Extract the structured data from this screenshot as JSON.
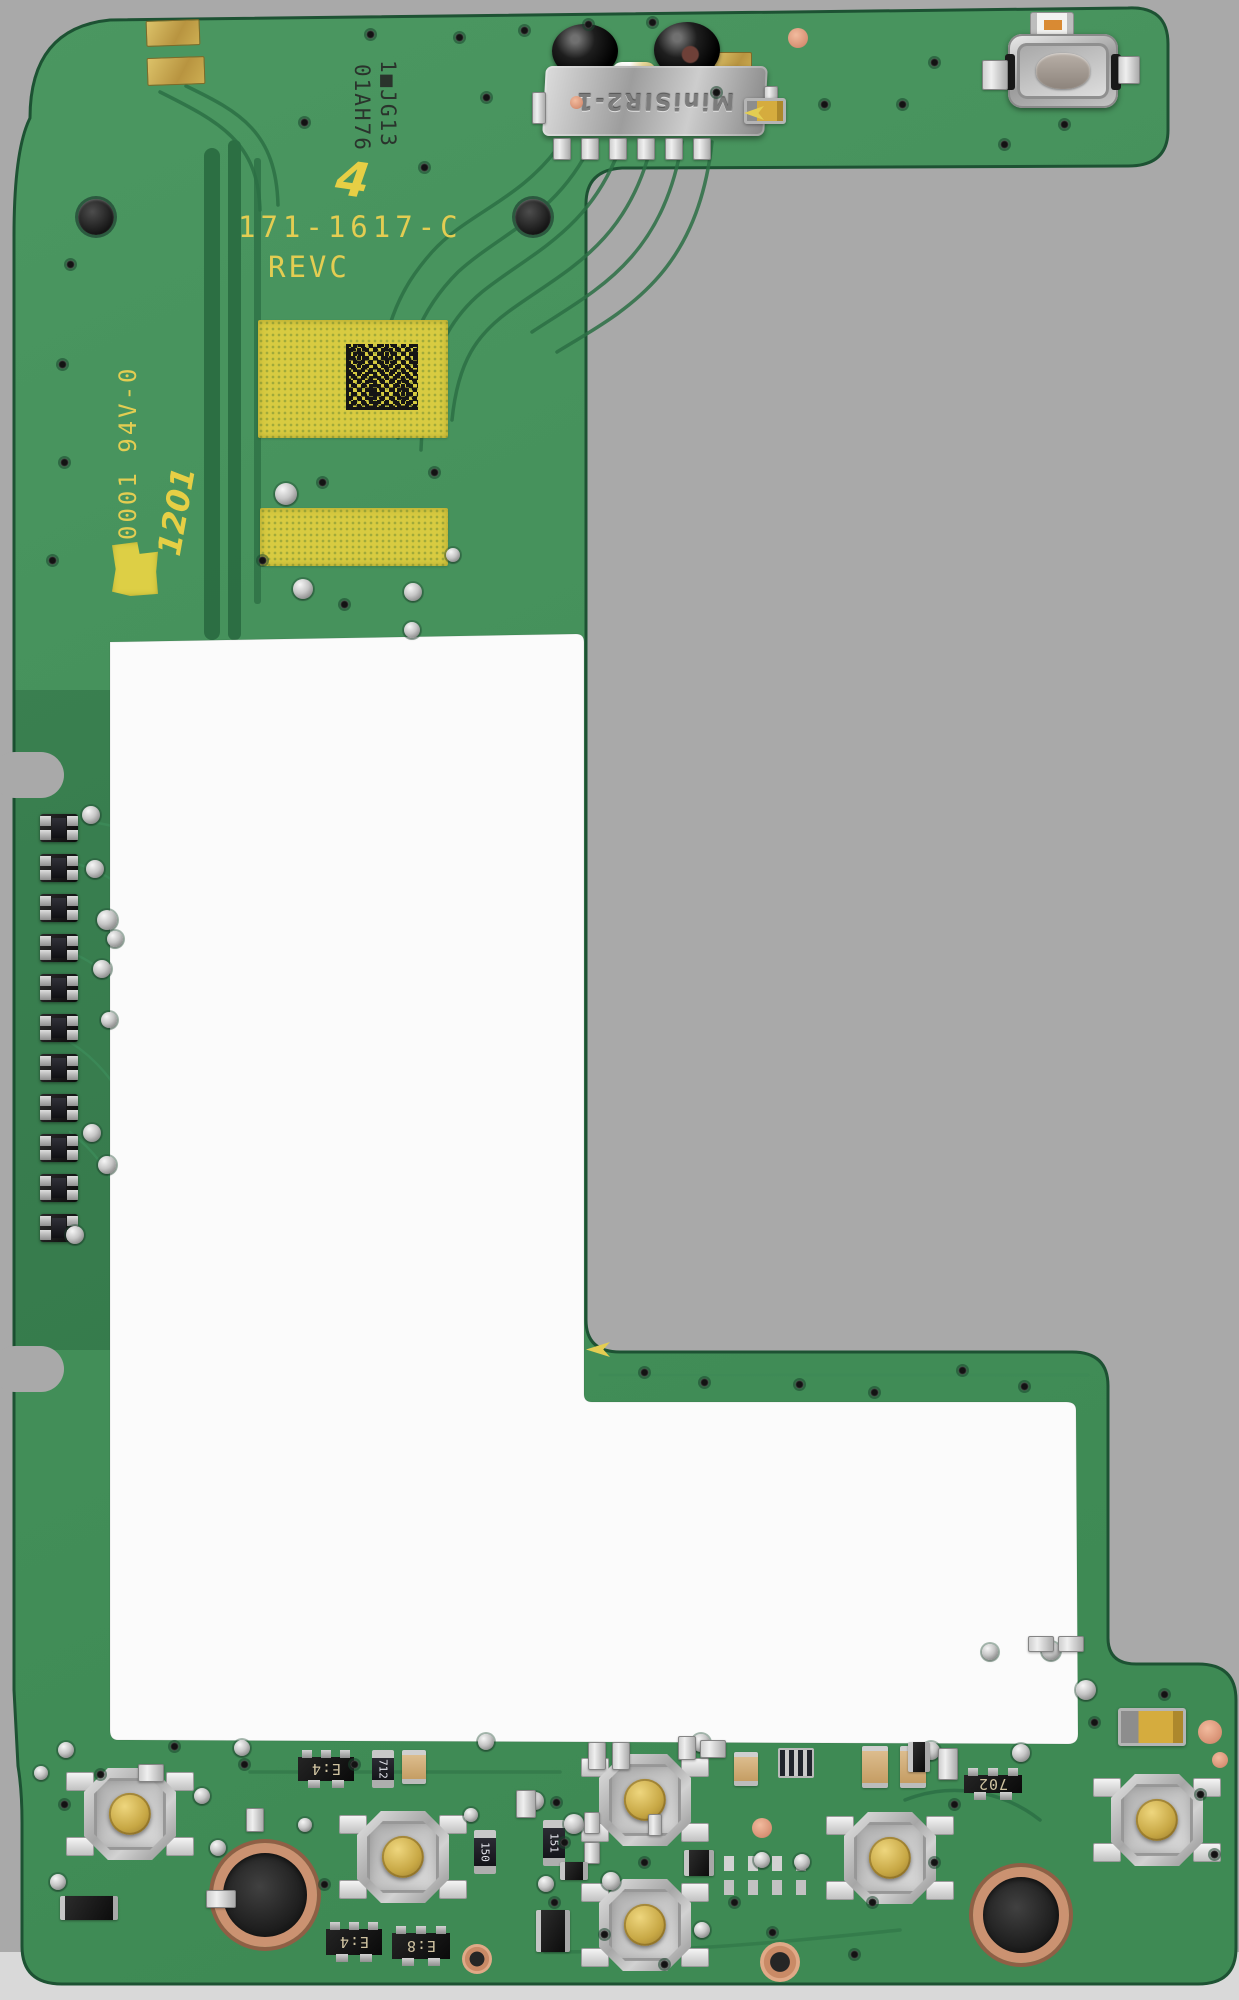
{
  "image": {
    "description": "Scanned photograph of a green printed circuit board (component side) with an L-shaped white masked region",
    "background_color": "#a9a9a9",
    "bottom_background_color": "#dcdcdc",
    "cutout_color": "#fbfbfb"
  },
  "board": {
    "solder_mask_color": "#44905a",
    "trace_color": "#2c7045",
    "silkscreen_color": "#e3cd52",
    "silkscreen": {
      "part_number": "171-1617-C",
      "revision": "REVC",
      "ul_rating": "0001 94V-0"
    },
    "laser_codes": {
      "line_1": "1■JG13",
      "line_2": "01AH76"
    },
    "handwritten": {
      "mark_top": "4",
      "mark_left": "1201"
    }
  },
  "components": {
    "ir_module": {
      "marking": "MiniSIR2-1"
    },
    "ic_e4_top": {
      "marking": "E:4"
    },
    "ic_e4_bottom": {
      "marking": "E:4"
    },
    "ic_e8_bottom": {
      "marking": "E:8"
    },
    "ic_702": {
      "marking": "702"
    },
    "resistor_712": {
      "marking": "712"
    },
    "resistor_150": {
      "marking": "150"
    },
    "resistor_151": {
      "marking": "151"
    }
  }
}
